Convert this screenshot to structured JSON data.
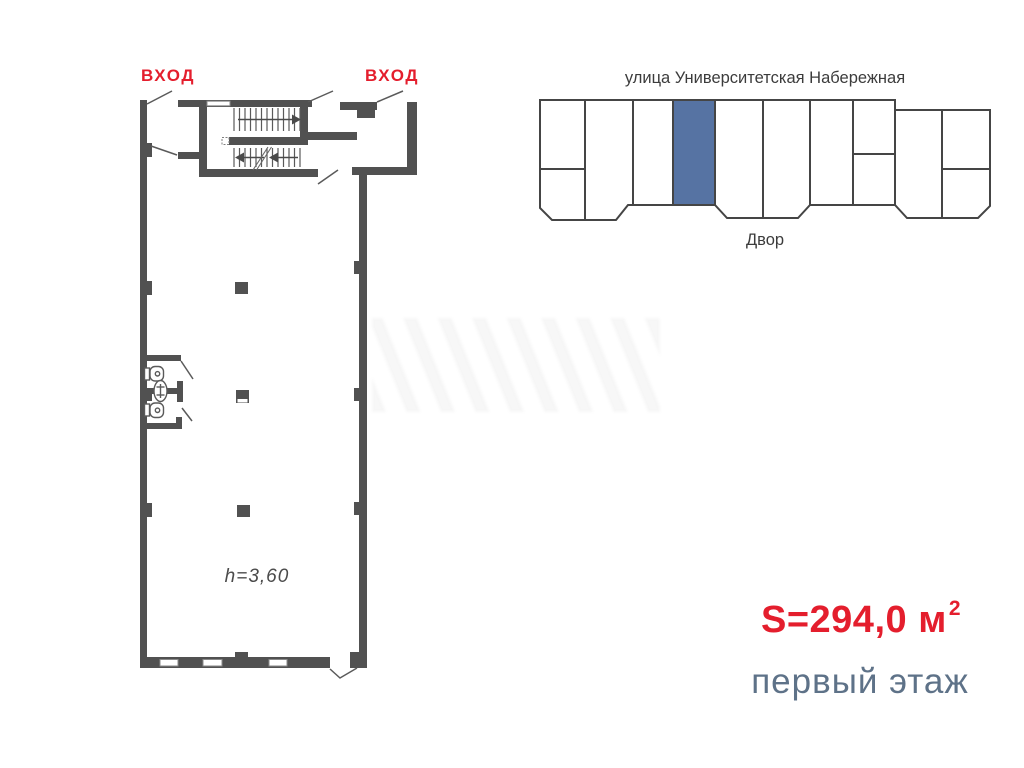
{
  "plan": {
    "entrance_left_label": "ВХОД",
    "entrance_right_label": "ВХОД",
    "height_label": "h=3,60"
  },
  "location_diagram": {
    "street_label": "улица Университетская Набережная",
    "yard_label": "Двор"
  },
  "summary": {
    "area_label": "S=294,0 м",
    "area_superscript": "2",
    "floor_label": "первый этаж"
  },
  "colors": {
    "accent_red": "#e41e2d",
    "slate_text": "#5e7288",
    "highlight_blue": "#5673a3",
    "wall_gray": "#515151",
    "outline_gray": "#454545"
  }
}
